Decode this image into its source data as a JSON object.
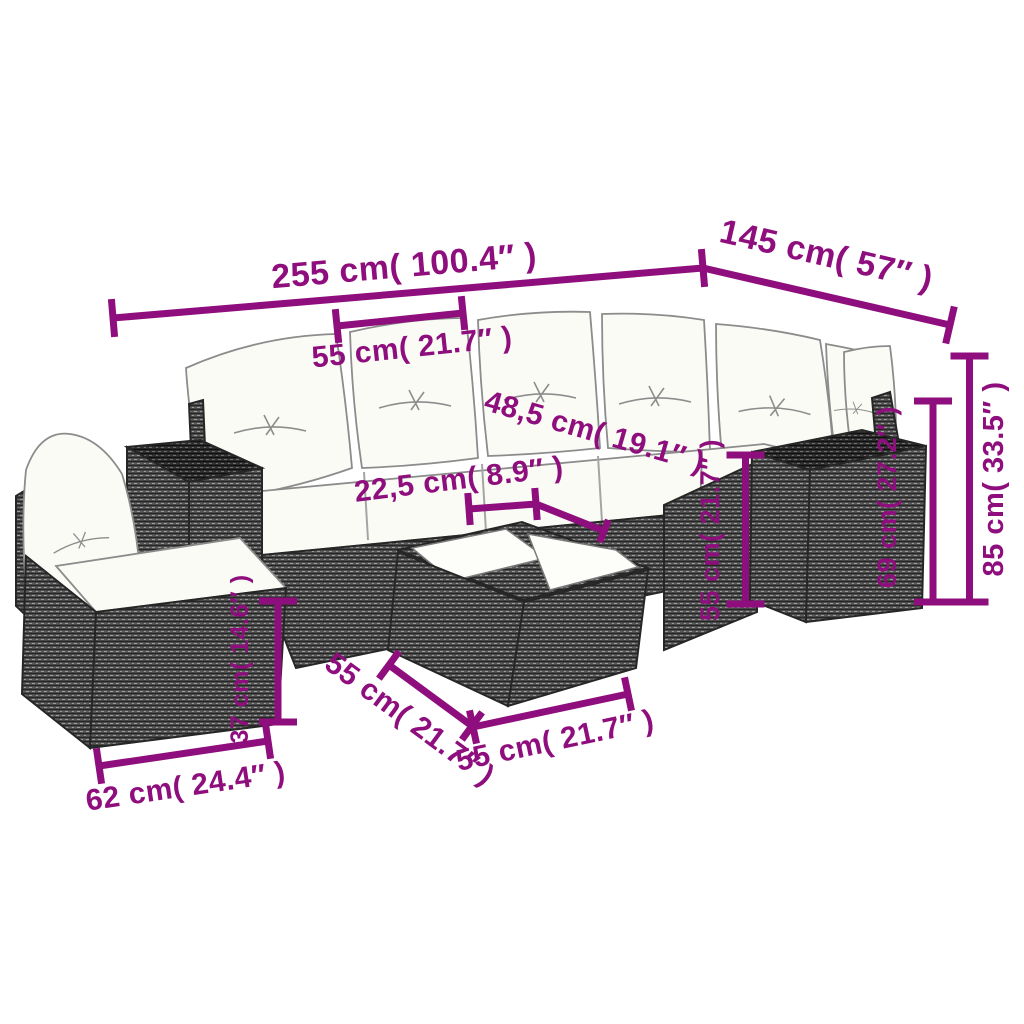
{
  "style": {
    "accent": "#8f0e7d",
    "background": "#ffffff",
    "wicker_gray": "#5d5d5d",
    "wicker_dark": "#3a3a3a",
    "cushion_white": "#fbfbf6"
  },
  "dims": {
    "len255": {
      "label": "255 cm( 100.4″ )"
    },
    "len145": {
      "label": "145 cm( 57″ )"
    },
    "cushion55": {
      "label": "55 cm( 21.7″ )"
    },
    "back485": {
      "label": "48,5 cm( 19.1″ )"
    },
    "seat225": {
      "label": "22,5 cm( 8.9″ )"
    },
    "corner55": {
      "label": "55 cm( 21.7″ )"
    },
    "side69": {
      "label": "69 cm( 27.2″ )"
    },
    "height85": {
      "label": "85 cm( 33.5″ )"
    },
    "seat37": {
      "label": "37 cm( 14.6″ )"
    },
    "chair62": {
      "label": "62 cm( 24.4″ )"
    },
    "tableL55": {
      "label": "55 cm( 21.7″ )"
    },
    "tableR55": {
      "label": "55 cm( 21.7″ )"
    }
  }
}
